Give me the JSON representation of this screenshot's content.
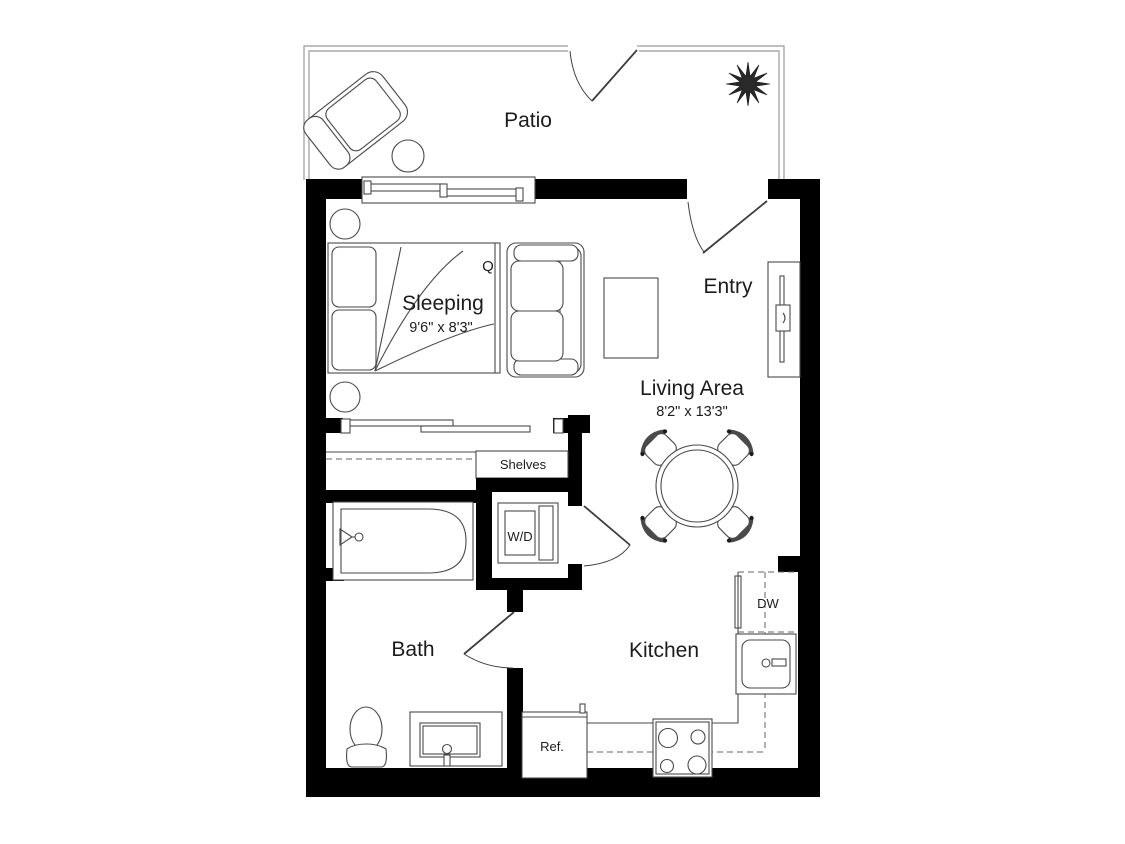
{
  "rooms": {
    "patio": {
      "label": "Patio"
    },
    "sleeping": {
      "label": "Sleeping",
      "dimensions": "9'6\" x 8'3\"",
      "bed_size_tag": "Q"
    },
    "living": {
      "label": "Living Area",
      "dimensions": "8'2\" x 13'3\""
    },
    "entry": {
      "label": "Entry"
    },
    "bath": {
      "label": "Bath"
    },
    "kitchen": {
      "label": "Kitchen"
    }
  },
  "fixtures": {
    "shelves": "Shelves",
    "washer_dryer": "W/D",
    "dishwasher": "DW",
    "refrigerator": "Ref."
  },
  "colors": {
    "background": "#ffffff",
    "wall": "#000000",
    "furniture_line": "#4a4a4a",
    "patio_line": "#999999",
    "door_line": "#3d3d3d",
    "dashed_line": "#666666",
    "text": "#1c1c1c"
  }
}
